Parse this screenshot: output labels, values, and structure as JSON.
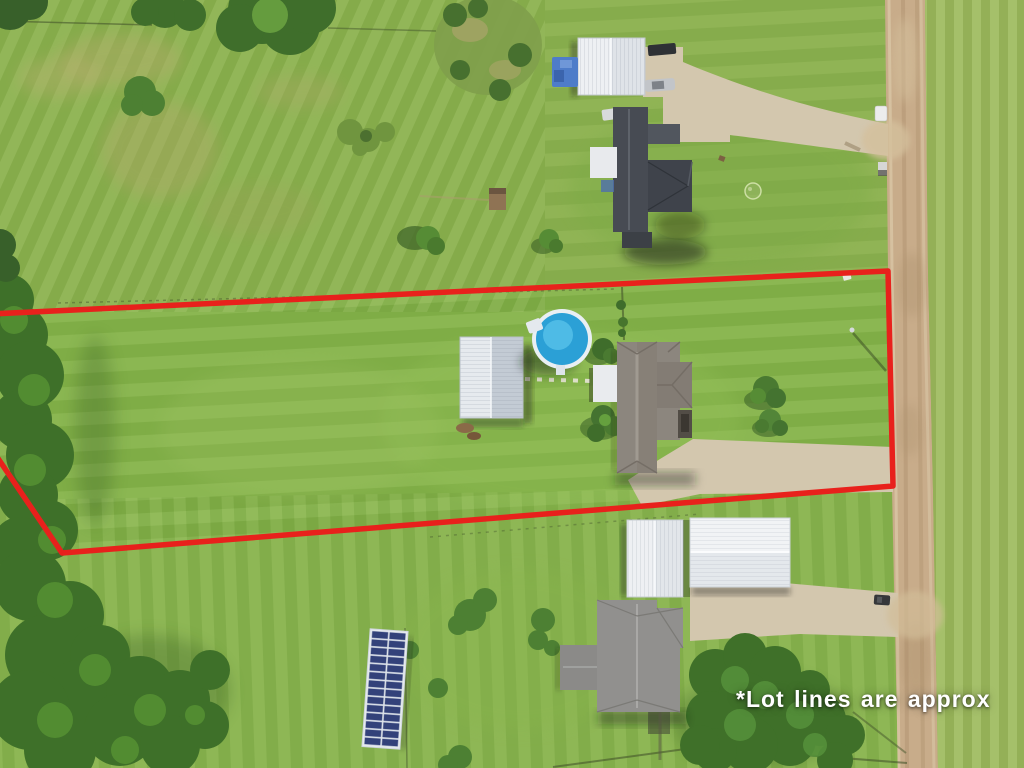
{
  "scene": {
    "kind": "aerial-drone-photo-of-rural-lots",
    "disclaimer": "*Lot lines are approx"
  },
  "colors": {
    "lot_line": "#e8211c",
    "grass": "#86b24c",
    "road": "#c8ac8a",
    "driveway": "#d3c7ae",
    "pool_water": "#2ba0d6",
    "disclaimer_text": "#ffffff"
  }
}
